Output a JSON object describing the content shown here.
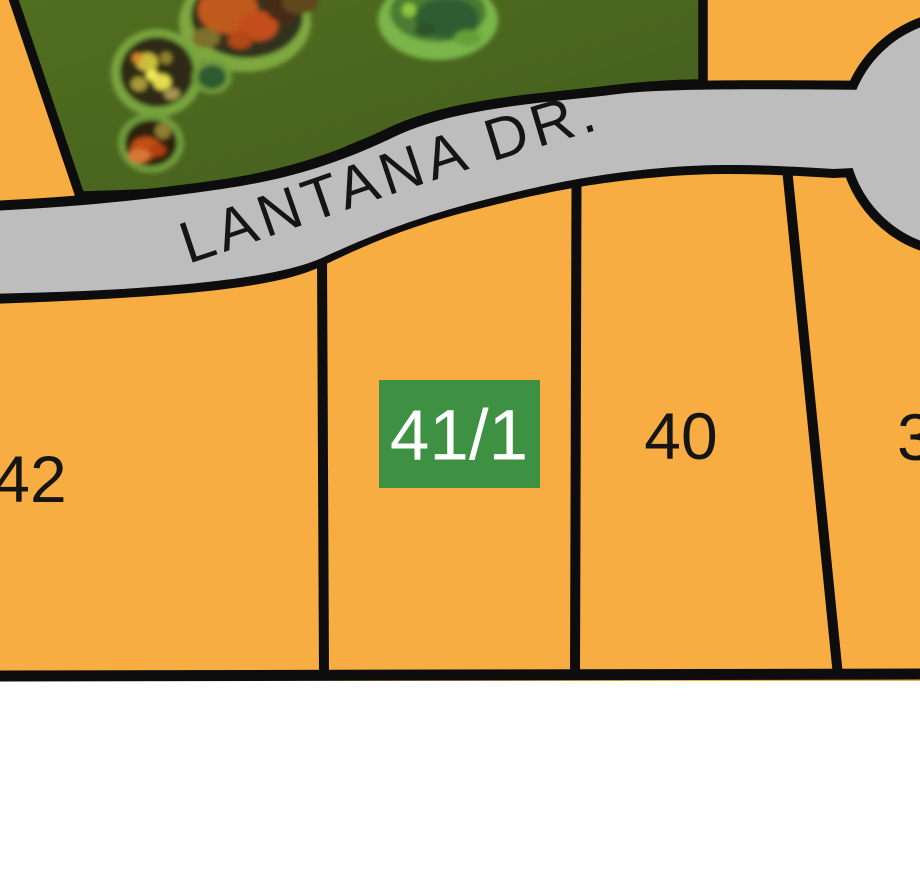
{
  "map": {
    "road": {
      "label": "LANTANA DR."
    },
    "lots": [
      {
        "number": "42",
        "highlighted": false
      },
      {
        "number": "41/1",
        "highlighted": true
      },
      {
        "number": "40",
        "highlighted": false
      },
      {
        "number": "39",
        "highlighted": false
      }
    ],
    "colors": {
      "parcel_fill": "#f7ad42",
      "road_fill": "#bdbdbd",
      "outline": "#0d0d0d",
      "forest_base": "#4a651e",
      "forest_tree_palette": [
        "#c05a1e",
        "#c44e1a",
        "#d7c93b",
        "#2e2a14",
        "#4c7c31",
        "#8dc63f",
        "#d87737"
      ],
      "highlight_fill": "#3e9143",
      "highlight_text": "#ffffff",
      "label_text": "#151515",
      "background": "#ffffff"
    }
  }
}
